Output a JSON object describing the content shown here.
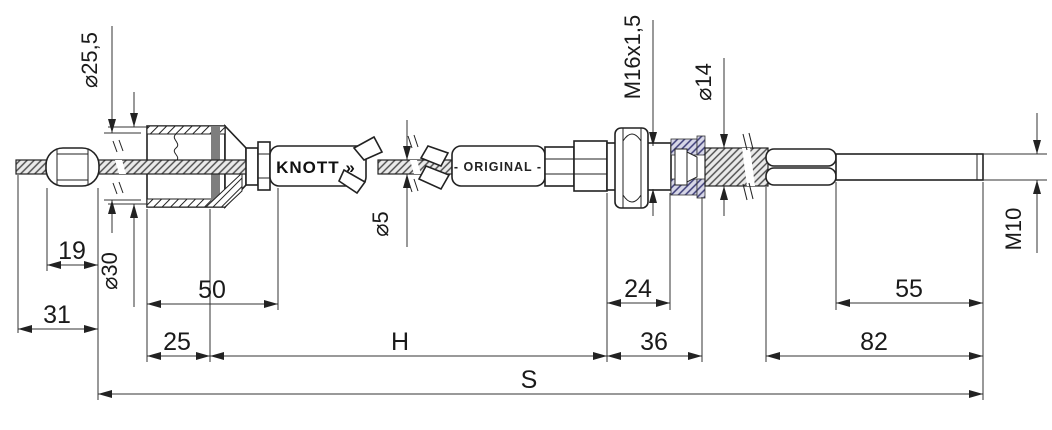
{
  "drawing": {
    "brand": {
      "logo": "KNOTT »"
    },
    "sleeve_text": "- ORIGINAL -",
    "diameter_labels": {
      "eye_bore": "⌀25,5",
      "eye_outer": "⌀30",
      "inner_cable": "⌀5",
      "adapter_thread": "M16x1,5",
      "conduit": "⌀14",
      "rod_thread": "M10"
    },
    "linear_dims": {
      "nipple_len": "19",
      "end_len": "31",
      "bell_len": "50",
      "bell_front": "25",
      "outer_len": "H",
      "adapter_len": "24",
      "adapter_total": "36",
      "thread_len": "55",
      "rod_len": "82",
      "total_len": "S"
    },
    "colors": {
      "line": "#222222",
      "dark_band": "#7e7e7e",
      "blue_hatch": "#3d3d78",
      "gray_hatch": "#4a4a4a"
    }
  }
}
